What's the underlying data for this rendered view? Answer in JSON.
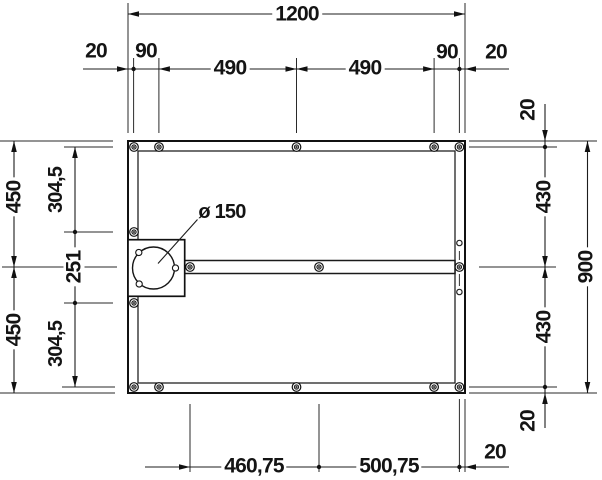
{
  "drawing": {
    "background": "#ffffff",
    "line_color": "#161616",
    "type": "technical-dimension-drawing"
  },
  "dims": {
    "total_width": "1200",
    "total_height": "900",
    "top": {
      "edge_left": "20",
      "offset_left": "90",
      "span_left": "490",
      "span_right": "490",
      "offset_right": "90",
      "edge_right": "20"
    },
    "left": {
      "half_upper": "450",
      "half_lower": "450",
      "inner_upper": "304,5",
      "drain_span": "251",
      "inner_lower": "304,5"
    },
    "right": {
      "edge_top": "20",
      "inner_upper": "430",
      "inner_lower": "430",
      "edge_bottom": "20"
    },
    "bottom": {
      "span_left": "460,75",
      "span_right": "500,75",
      "edge_right": "20"
    },
    "drain": {
      "diameter_label": "ø 150"
    }
  }
}
